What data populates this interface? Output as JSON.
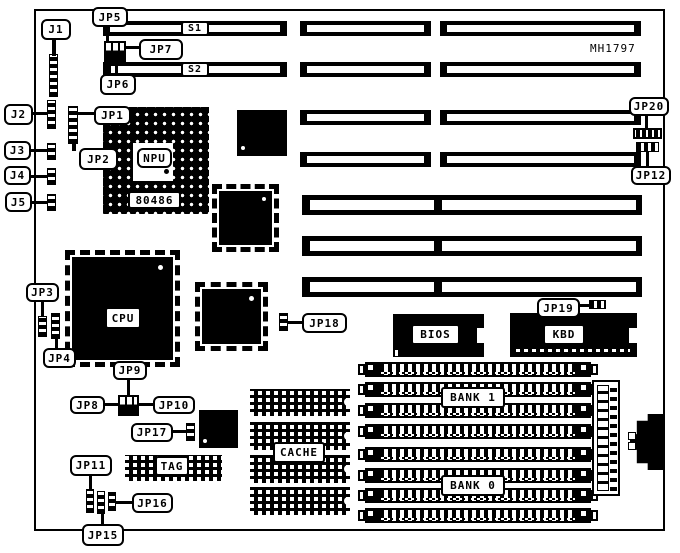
{
  "title": "Motherboard jumper and connector location diagram",
  "part_number": "MH1797",
  "labels": {
    "j1": "J1",
    "j2": "J2",
    "j3": "J3",
    "j4": "J4",
    "j5": "J5",
    "jp1": "JP1",
    "jp2": "JP2",
    "jp3": "JP3",
    "jp4": "JP4",
    "jp5": "JP5",
    "jp6": "JP6",
    "jp7": "JP7",
    "jp8": "JP8",
    "jp9": "JP9",
    "jp10": "JP10",
    "jp11": "JP11",
    "jp12": "JP12",
    "jp15": "JP15",
    "jp16": "JP16",
    "jp17": "JP17",
    "jp18": "JP18",
    "jp19": "JP19",
    "jp20": "JP20"
  },
  "components": {
    "s1": "S1",
    "s2": "S2",
    "npu": "NPU",
    "cpu_socket": "80486",
    "cpu": "CPU",
    "bios": "BIOS",
    "kbd": "KBD",
    "tag": "TAG",
    "cache": "CACHE",
    "bank1": "BANK 1",
    "bank0": "BANK 0"
  }
}
